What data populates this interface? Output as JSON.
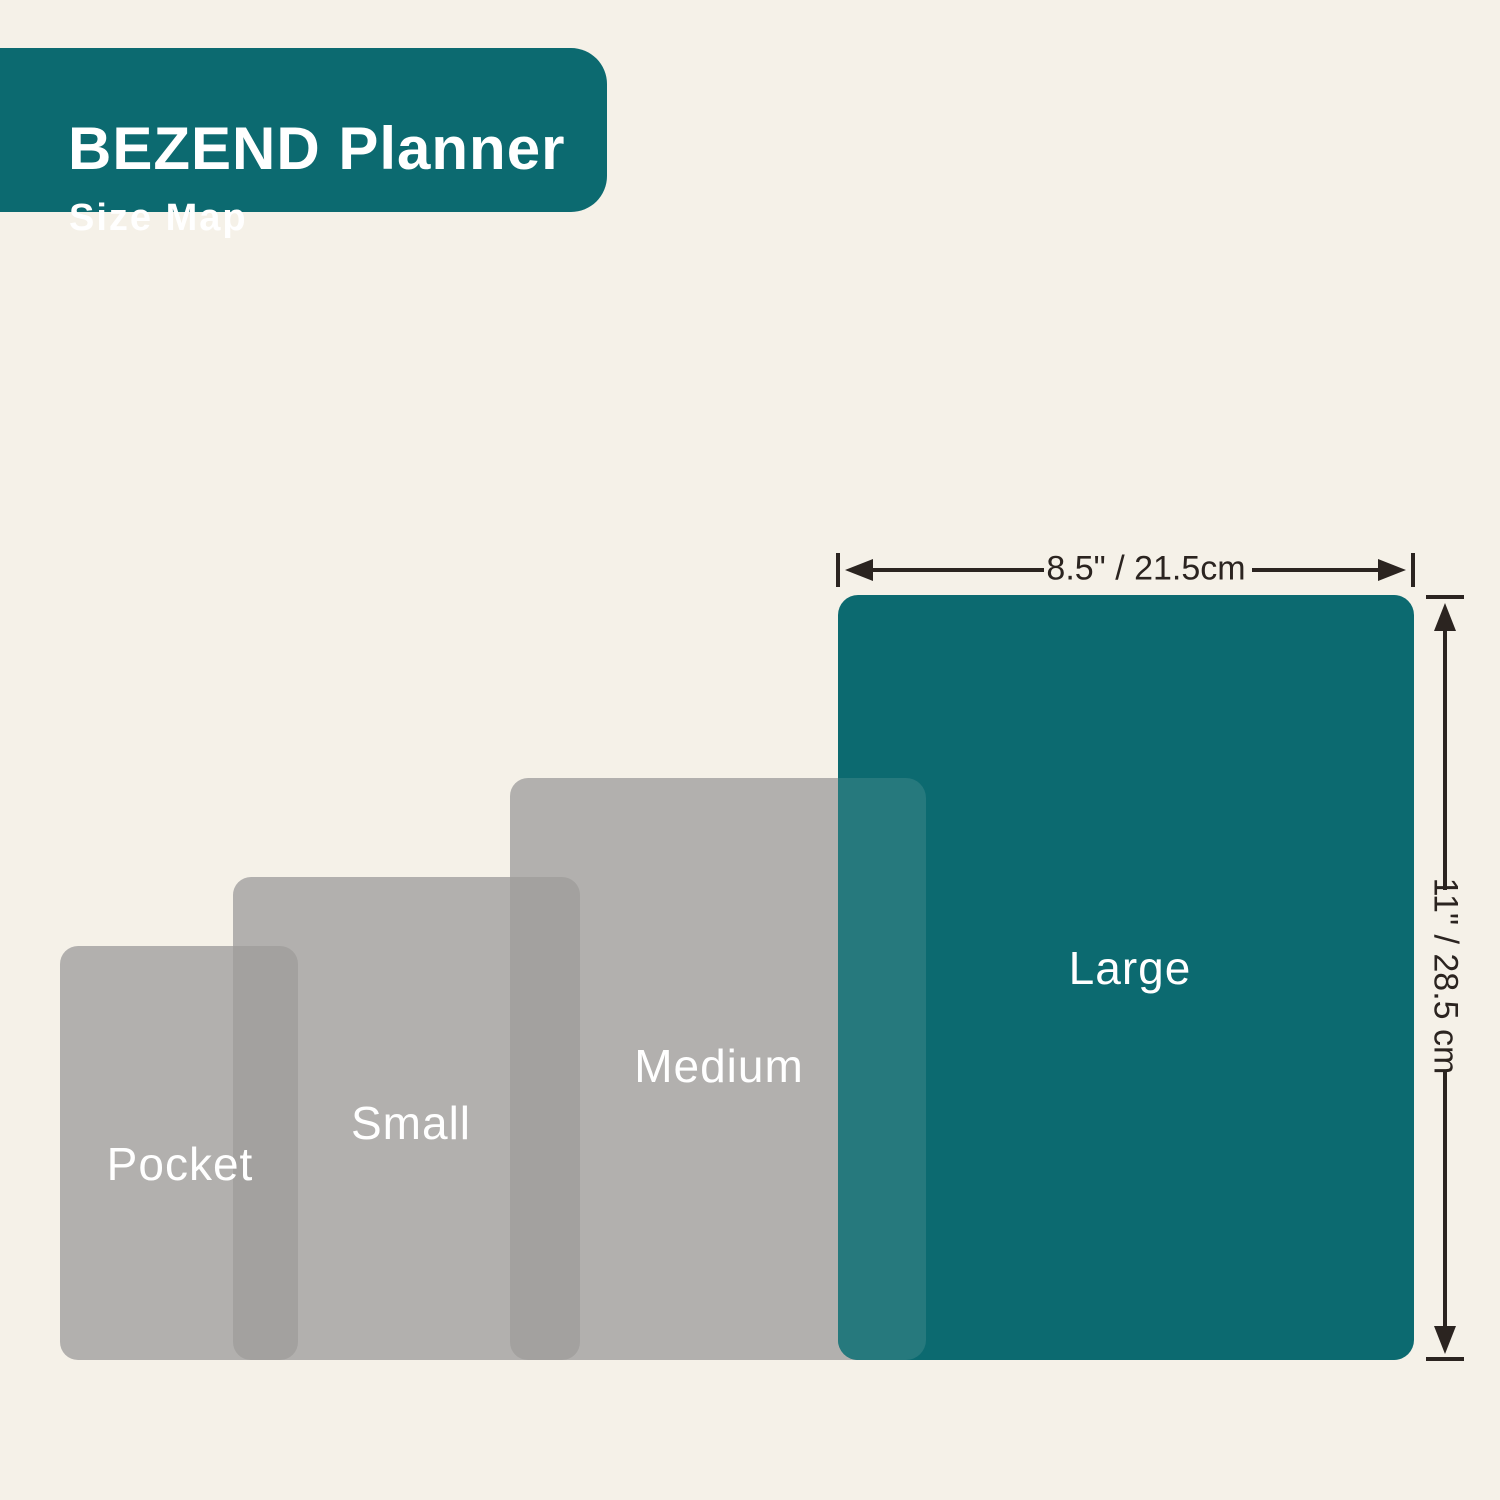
{
  "header": {
    "title": "BEZEND Planner",
    "subtitle": "Size Map"
  },
  "sizes": [
    {
      "id": "pocket",
      "label": "Pocket"
    },
    {
      "id": "small",
      "label": "Small"
    },
    {
      "id": "medium",
      "label": "Medium"
    },
    {
      "id": "large",
      "label": "Large"
    }
  ],
  "dimensions": {
    "width_label": "8.5\" / 21.5cm",
    "height_label": "11\" / 28.5 cm"
  },
  "colors": {
    "background": "#F5F1E8",
    "teal": "#0C6A70",
    "gray": "#B2B0AE",
    "gray_overlap": "#A3A19F",
    "teal_gray_overlap": "#26797D",
    "arrow": "#2B2420",
    "label_text": "#FFFFFF"
  }
}
